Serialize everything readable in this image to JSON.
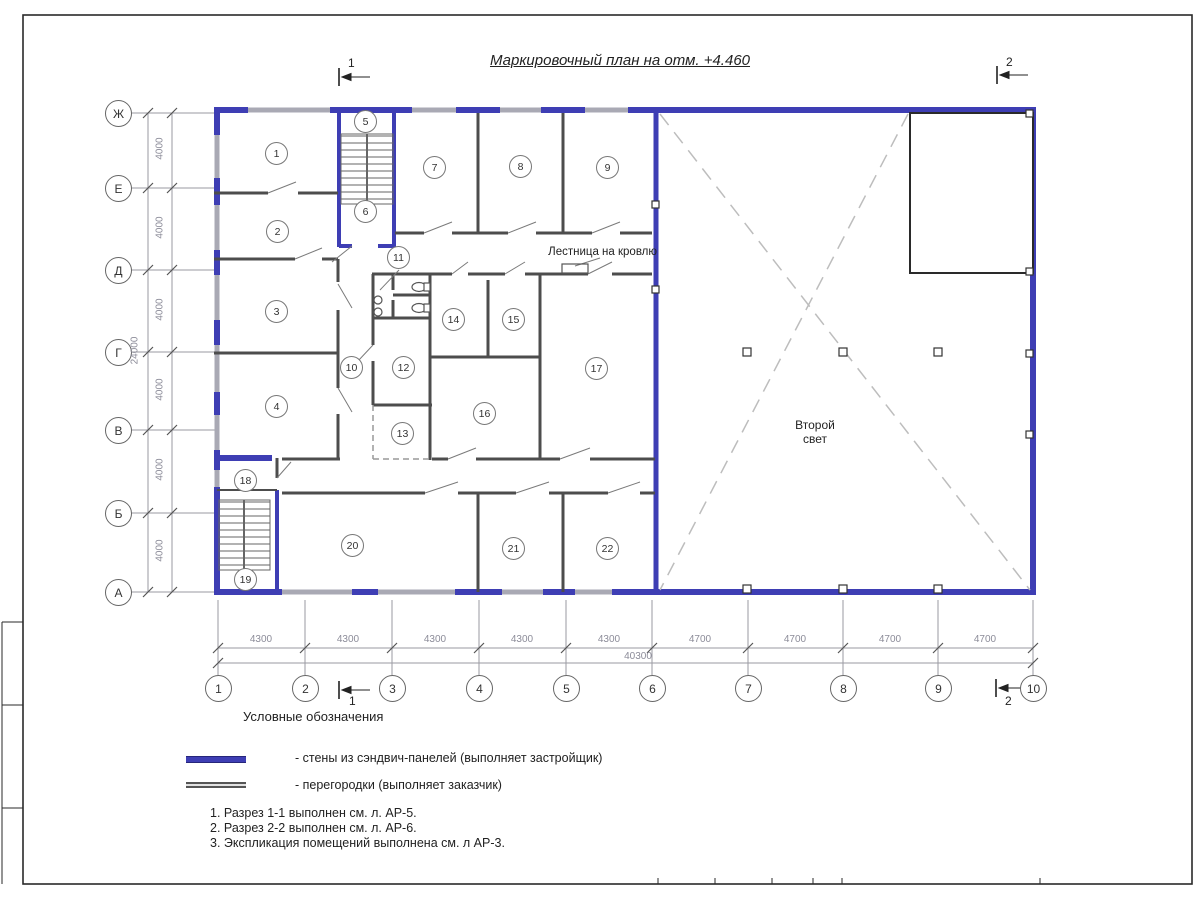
{
  "title": "Маркировочный план на отм. +4.460",
  "section_marks": {
    "top_left": "1",
    "top_right": "2",
    "bottom_left": "1",
    "bottom_right": "2"
  },
  "axes": {
    "rows": [
      "Ж",
      "Е",
      "Д",
      "Г",
      "В",
      "Б",
      "А"
    ],
    "cols": [
      "1",
      "2",
      "3",
      "4",
      "5",
      "6",
      "7",
      "8",
      "9",
      "10"
    ],
    "row_spacing": [
      "4000",
      "4000",
      "4000",
      "4000",
      "4000",
      "4000"
    ],
    "row_total": "24000",
    "col_spacing": [
      "4300",
      "4300",
      "4300",
      "4300",
      "4300",
      "4700",
      "4700",
      "4700",
      "4700"
    ],
    "col_total": "40300"
  },
  "rooms": [
    "1",
    "2",
    "3",
    "4",
    "5",
    "6",
    "7",
    "8",
    "9",
    "10",
    "11",
    "12",
    "13",
    "14",
    "15",
    "16",
    "17",
    "18",
    "19",
    "20",
    "21",
    "22"
  ],
  "labels": {
    "roof_stairs": "Лестница на кровлю",
    "second_light": "Второй\nсвет"
  },
  "legend": {
    "heading": "Условные обозначения",
    "items": [
      {
        "swatch": "sandwich-wall",
        "label": "- стены из сэндвич-панелей (выполняет застройщик)"
      },
      {
        "swatch": "partition-wall",
        "label": "- перегородки (выполняет заказчик)"
      }
    ]
  },
  "notes": [
    "1. Разрез 1-1 выполнен см. л. АР-5.",
    "2. Разрез 2-2 выполнен см. л. АР-6.",
    "3. Экспликация помещений выполнена см. л АР-3."
  ],
  "colors": {
    "sandwich_wall": "#3e3eb4",
    "partition": "#4d4d4d",
    "window": "#a9a9b4"
  }
}
